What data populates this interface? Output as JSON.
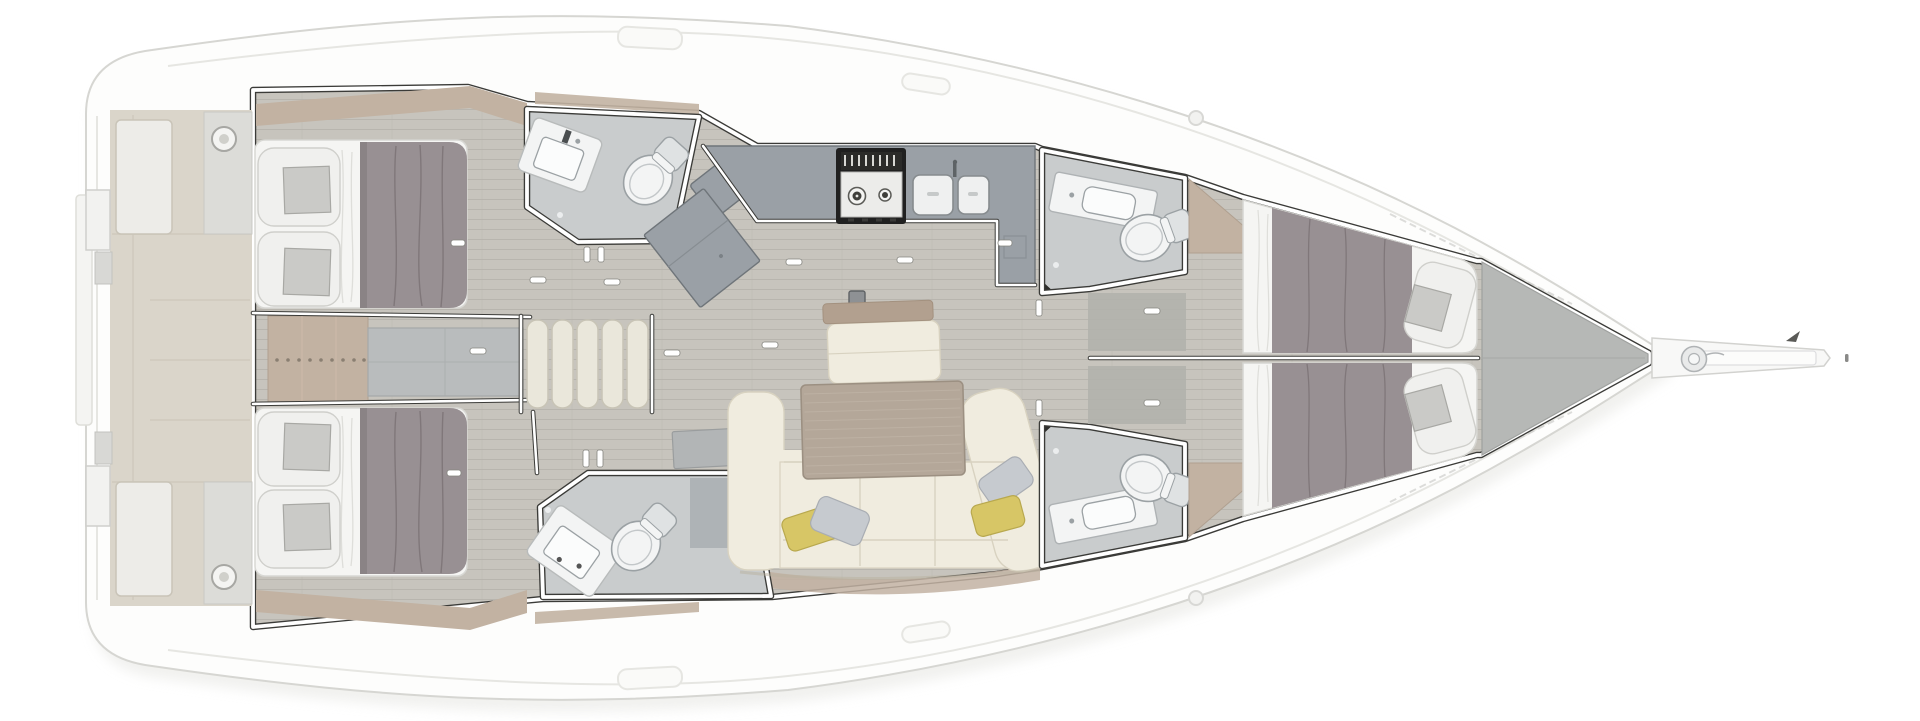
{
  "diagram": {
    "type": "yacht-interior-floor-plan",
    "view": "top-down",
    "orientation": {
      "bow": "right",
      "stern": "left"
    },
    "areas": [
      {
        "id": "swim-platform-transom",
        "features": [
          "storage-lockers",
          "circular-deck-hatches",
          "transom-gates"
        ]
      },
      {
        "id": "aft-cabin-port",
        "features": [
          "double-berth",
          "two-pillows",
          "gray-duvet",
          "taupe-headboard-shelf"
        ]
      },
      {
        "id": "aft-cabin-starboard",
        "features": [
          "double-berth",
          "two-pillows",
          "gray-duvet",
          "taupe-headboard-shelf"
        ]
      },
      {
        "id": "engine-compartment",
        "features": [
          "access-hatch",
          "fastener-dot-row",
          "taupe-dresser"
        ]
      },
      {
        "id": "companionway",
        "features": [
          "five-step-ladder"
        ]
      },
      {
        "id": "aft-head-port",
        "features": [
          "washbasin",
          "toilet",
          "floor-drain"
        ]
      },
      {
        "id": "aft-head-starboard",
        "features": [
          "washbasin",
          "toilet",
          "shower-bench",
          "floor-drain"
        ]
      },
      {
        "id": "nav-station",
        "features": [
          "chart-table",
          "seat"
        ]
      },
      {
        "id": "galley",
        "features": [
          "l-shaped-counter",
          "two-burner-stove",
          "double-sink",
          "worktop-board"
        ]
      },
      {
        "id": "salon",
        "features": [
          "l-shaped-sofa",
          "dining-table",
          "bench-seat",
          "backrest-rail",
          "yellow-pillows",
          "gray-pillows",
          "mast-post"
        ]
      },
      {
        "id": "forward-head-port",
        "features": [
          "washbasin",
          "toilet"
        ]
      },
      {
        "id": "forward-head-starboard",
        "features": [
          "washbasin",
          "toilet"
        ]
      },
      {
        "id": "forward-cabin-port",
        "features": [
          "v-berth",
          "gray-duvet",
          "pillow",
          "taupe-wardrobe-wedge"
        ]
      },
      {
        "id": "forward-cabin-starboard",
        "features": [
          "v-berth",
          "gray-duvet",
          "pillow",
          "taupe-wardrobe-wedge"
        ]
      },
      {
        "id": "forepeak-sail-locker",
        "features": []
      },
      {
        "id": "bow",
        "features": [
          "bowsprit",
          "anchor-windlass",
          "forestay-fitting",
          "wind-indicator"
        ]
      }
    ]
  },
  "palette": {
    "hull": "#fdfdfc",
    "hull_stroke": "#d6d6d2",
    "deck_line": "#e6e6e2",
    "shadow": "#e5e5e1",
    "floor": "#c7c4bd",
    "floor_line": "#b8b5ae",
    "wall_dark": "#3b3b38",
    "wall_white": "#ffffff",
    "bath_floor": "#c9cccd",
    "fixture": "#f3f4f4",
    "fixture_stroke": "#9ba1a4",
    "fixture_shadow": "#dfe2e3",
    "counter": "#9aa0a6",
    "counter_stroke": "#6f757a",
    "stove_body": "#202020",
    "stove_top": "#ececea",
    "sink_fill": "#eff0f0",
    "taupe": "#c2b2a2",
    "taupe_deep": "#b2a08f",
    "table": "#b4a799",
    "table_line": "#c3b7aa",
    "sofa": "#f0ecdf",
    "sofa_line": "#d8d2c0",
    "pillow_yellow": "#d7c666",
    "pillow_gray": "#c6cacf",
    "mattress": "#f5f5f3",
    "pillow_case": "#f0f0ee",
    "pillow_insert": "#cacac7",
    "pillow_edge": "#cfcfcb",
    "duvet": "#989093",
    "duvet_line": "#7b7376",
    "steps": "#eae7db",
    "steps_stroke": "#c8c4b6",
    "dresser_gray": "#b9bcbd",
    "forepeak": "#b6b8b6",
    "locker_gray": "#b0b1ac",
    "slab_gray": "#b2b5b6",
    "beige": "#dad5ca",
    "beige_light": "#edece8",
    "beige_stroke": "#c9c4b8",
    "metal": "#e9eaea",
    "metal_stroke": "#b0b3b5",
    "mast": "#8e9194",
    "dot": "#8a7f72"
  }
}
